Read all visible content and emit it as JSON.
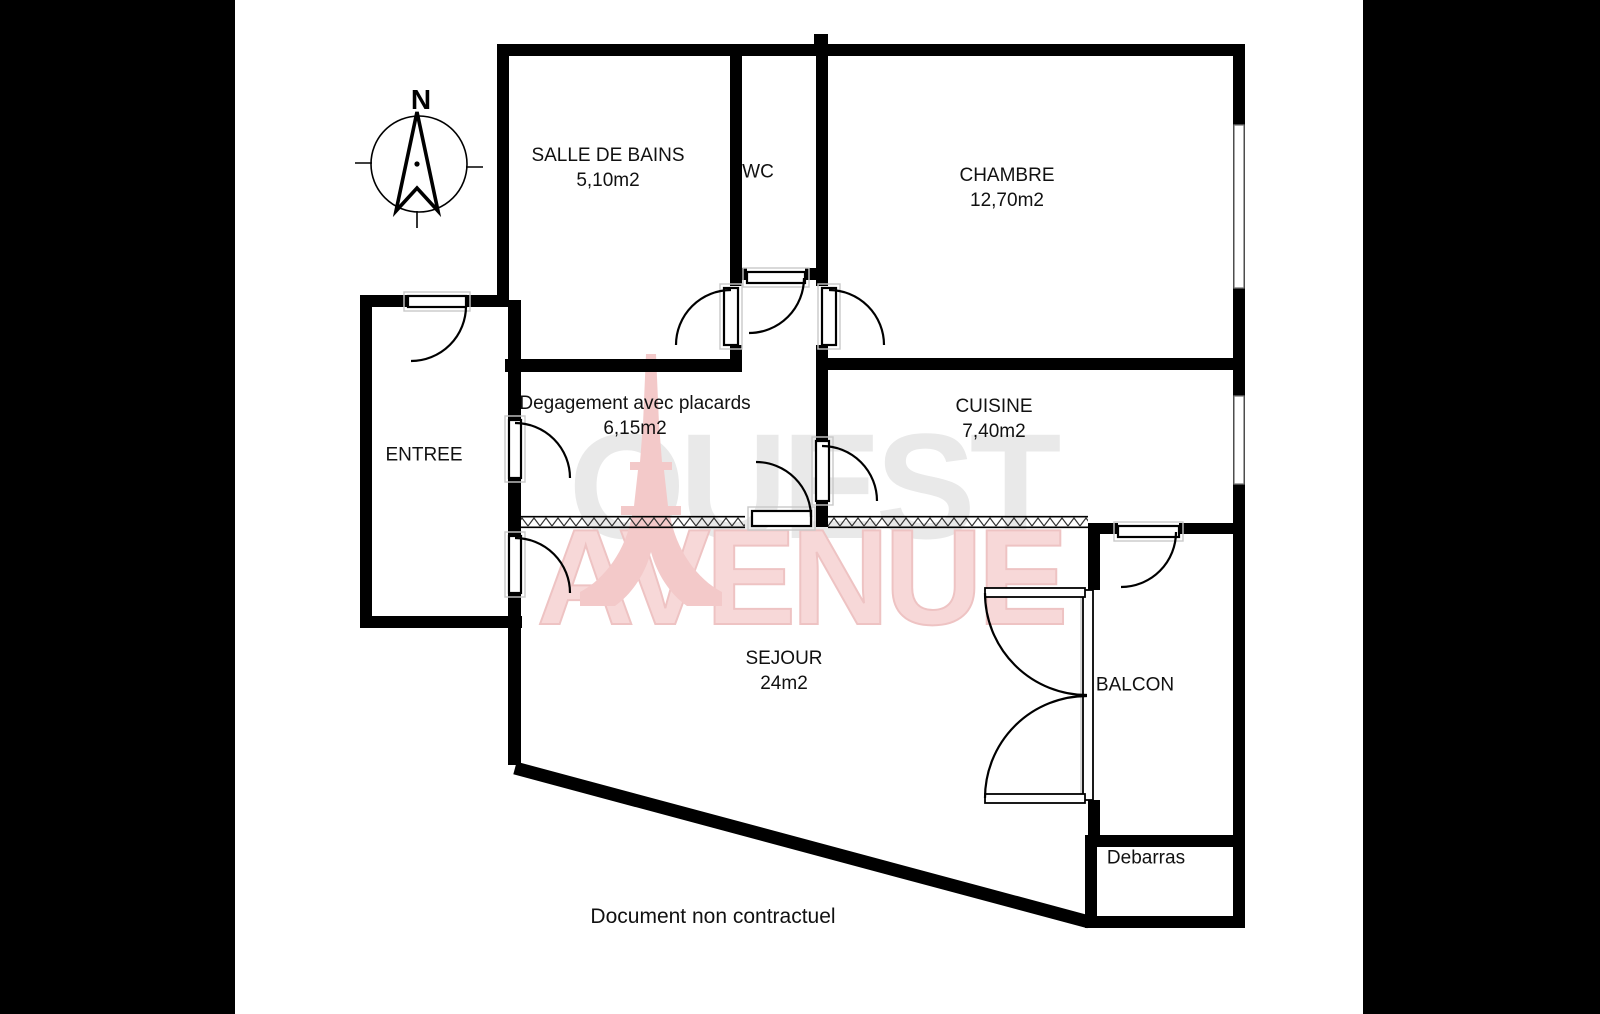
{
  "compass": {
    "north_label": "N"
  },
  "watermark": {
    "line1": "OUEST",
    "line2": "AVENUE"
  },
  "rooms": {
    "salle_de_bains": {
      "name": "SALLE DE BAINS",
      "area": "5,10m2"
    },
    "wc": {
      "name": "WC"
    },
    "chambre": {
      "name": "CHAMBRE",
      "area": "12,70m2"
    },
    "entree": {
      "name": "ENTREE"
    },
    "degagement": {
      "name": "Degagement avec placards",
      "area": "6,15m2"
    },
    "cuisine": {
      "name": "CUISINE",
      "area": "7,40m2"
    },
    "sejour": {
      "name": "SEJOUR",
      "area": "24m2"
    },
    "balcon": {
      "name": "BALCON"
    },
    "debarras": {
      "name": "Debarras"
    }
  },
  "footer": {
    "disclaimer": "Document non contractuel"
  },
  "colors": {
    "wall": "#000000",
    "background": "#ffffff",
    "letterbox": "#000000",
    "watermark_grey": "#e9e9e9",
    "watermark_pink": "#f7d8d8",
    "tower_pink": "#f3c9c9"
  }
}
